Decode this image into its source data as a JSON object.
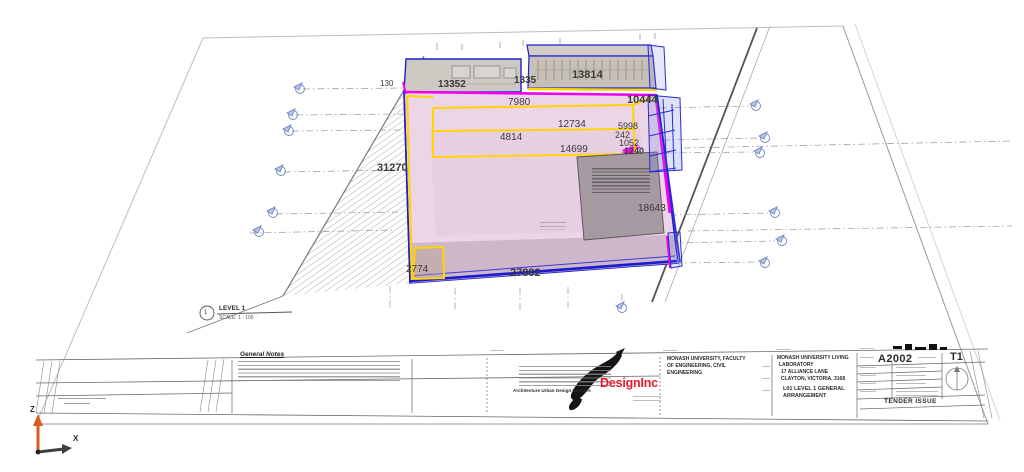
{
  "drawing": {
    "dimensions": [
      "130",
      "13352",
      "1335",
      "13814",
      "7980",
      "10444",
      "12734",
      "5998",
      "242",
      "1052",
      "1240",
      "4814",
      "14699",
      "31270",
      "18643",
      "2774",
      "27882"
    ],
    "view_title": {
      "number": "1",
      "name": "LEVEL 1",
      "scale": "SCALE:  1 : 100"
    },
    "axis": {
      "up": "Z",
      "right": "X"
    }
  },
  "title_block": {
    "general_notes_heading": "General Notes",
    "architect": {
      "logo_text": "DesignInc",
      "tagline": "Architecture  Urban Design  Interiors"
    },
    "consultant_lines": [
      "MONASH UNIVERSITY, FACULTY",
      "OF ENGINEERING, CIVIL",
      "ENGINEERING"
    ],
    "project_lines": [
      "MONASH UNIVERSITY LIVING",
      "LABORATORY",
      "17 ALLIANCE LANE",
      "CLAYTON, VICTORIA, 3168"
    ],
    "drawing_title_lines": [
      "L01 LEVEL 1 GENERAL",
      "ARRANGEMENT"
    ],
    "number_block": {
      "drawing_number": "A2002",
      "revision": "T1",
      "issue": "TENDER ISSUE"
    }
  },
  "colors": {
    "slab_pink": "#ecd5e7",
    "slab_front": "#c9b1c6",
    "magenta": "#f000f0",
    "yellow": "#ffd400",
    "outline_blue": "#1b1bd0",
    "band_gray": "#cdc9c3",
    "room_gray": "#a59aa1",
    "marker_blue": "#6d87c4",
    "axis_orange": "#d95b20",
    "logo_red": "#e8192c"
  }
}
